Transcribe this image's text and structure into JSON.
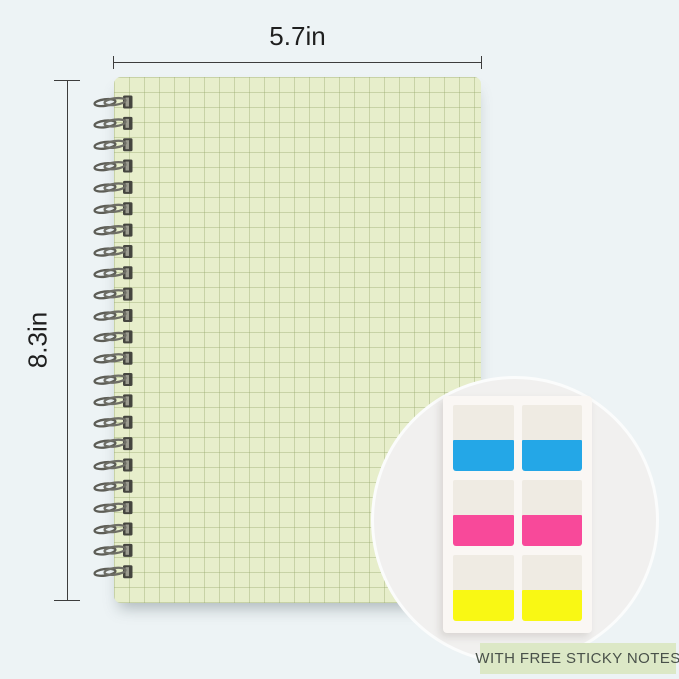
{
  "dimensions": {
    "width_label": "5.7in",
    "height_label": "8.3in",
    "line_color": "#3c3c3c"
  },
  "notebook": {
    "description": "grid-pattern spiral notebook cover",
    "cover_color": "#e7eecb",
    "grid_line_color": "#94a66a",
    "coil_count": 23,
    "coil_spacing_px": 21.35
  },
  "inset": {
    "badge_label": "WITH FREE STICKY NOTES",
    "badge_bg": "#dce8c6",
    "badge_text_color": "#49514a",
    "sheet_color": "#faf7f4",
    "tabs_per_row": 2,
    "tab_rows": [
      {
        "name": "blue",
        "color": "#24a7e7"
      },
      {
        "name": "pink",
        "color": "#f8499a"
      },
      {
        "name": "yellow",
        "color": "#f9f814"
      }
    ]
  }
}
